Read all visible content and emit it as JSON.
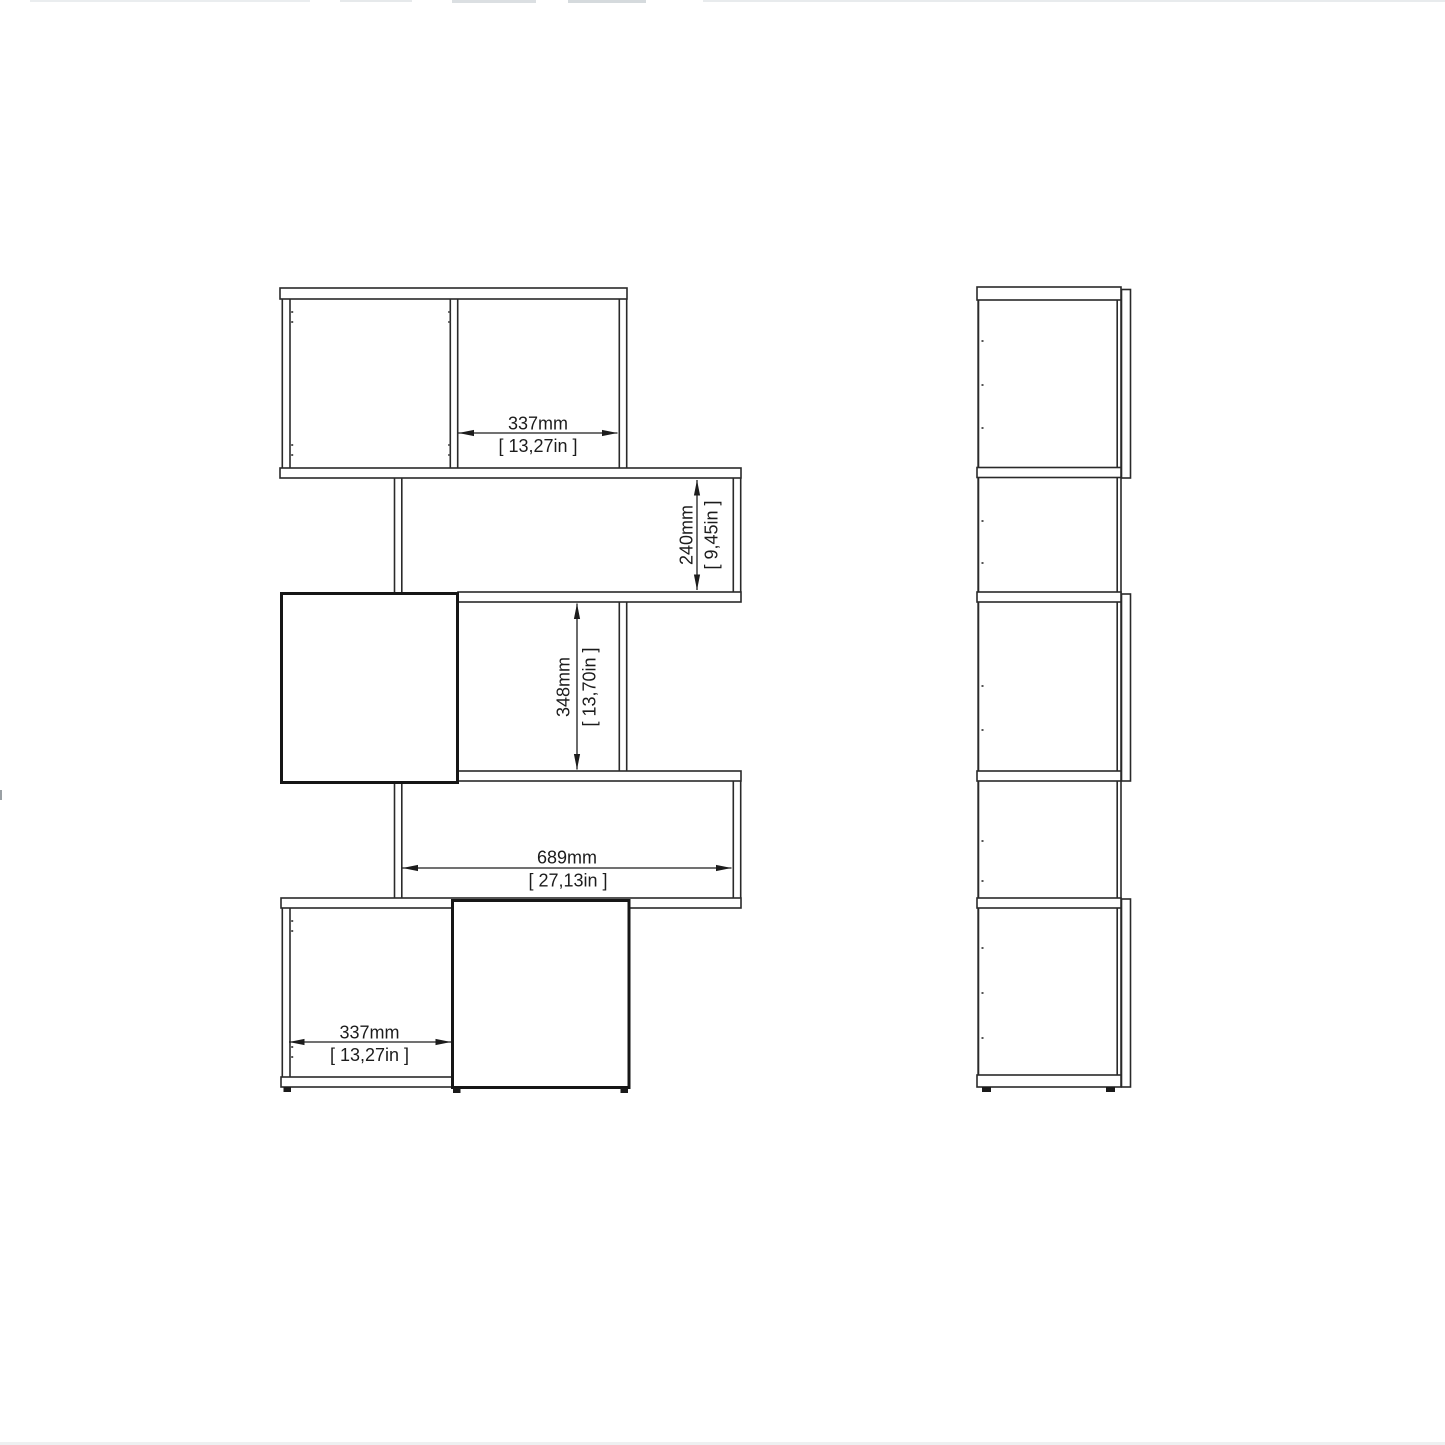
{
  "drawing": {
    "background": "#ffffff",
    "colors": {
      "line": "#2a2a2a",
      "door_line": "#161616",
      "text": "#1c1c1c"
    },
    "views": {
      "front": "front-elevation",
      "side": "side-elevation"
    },
    "dimensions": {
      "top_cube_width": {
        "metric": "337mm",
        "imperial": "[ 13,27in ]"
      },
      "shelf_gap_height": {
        "metric": "240mm",
        "imperial": "[ 9,45in ]"
      },
      "middle_cube_height": {
        "metric": "348mm",
        "imperial": "[ 13,70in ]"
      },
      "long_shelf_width": {
        "metric": "689mm",
        "imperial": "[ 27,13in ]"
      },
      "bottom_cube_width": {
        "metric": "337mm",
        "imperial": "[ 13,27in ]"
      }
    }
  }
}
